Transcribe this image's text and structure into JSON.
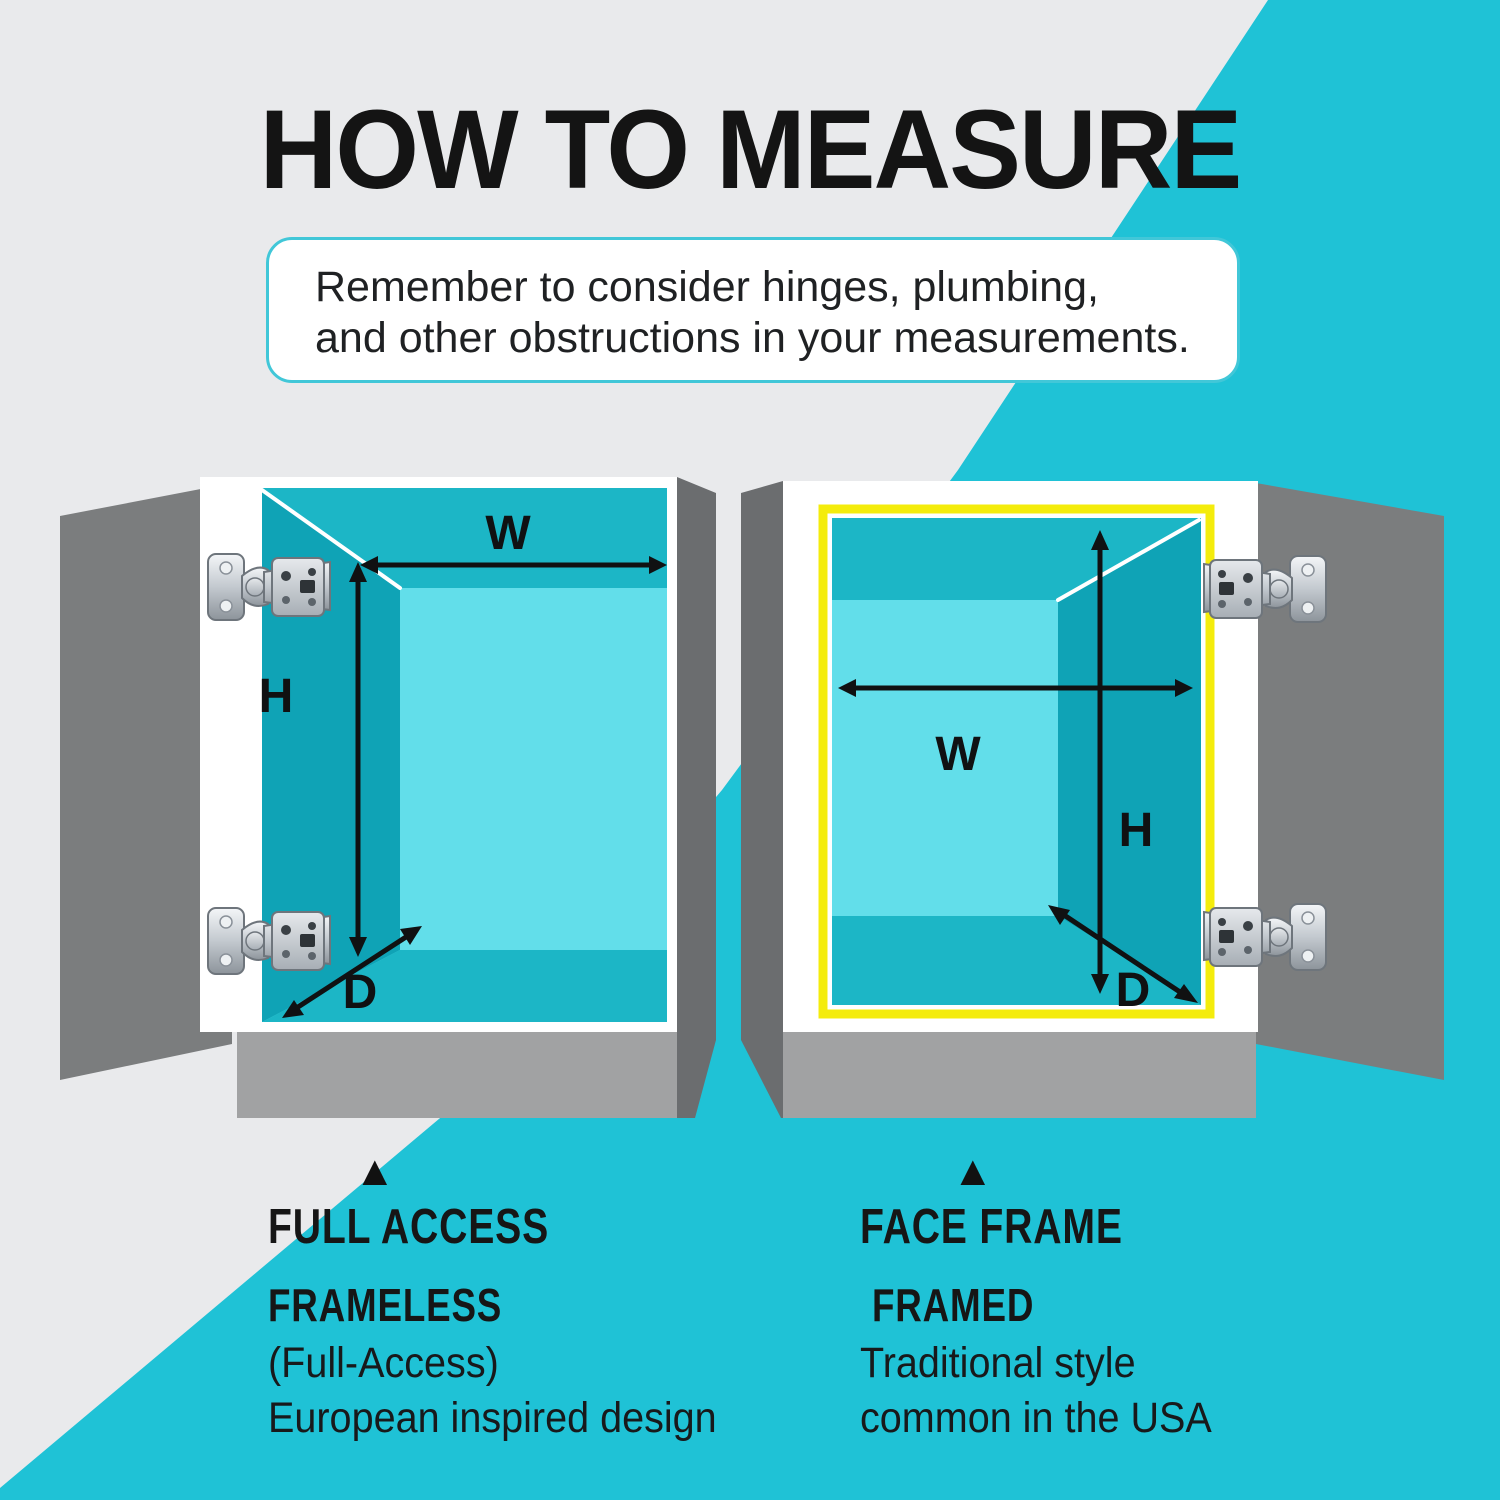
{
  "title": "HOW TO MEASURE",
  "note": {
    "line1": "Remember to consider hinges, plumbing,",
    "line2": "and other obstructions in your measurements."
  },
  "dimensions": {
    "width_label": "W",
    "height_label": "H",
    "depth_label": "D"
  },
  "left_caption": {
    "marker": "▲",
    "heading": "FULL ACCESS",
    "style_name": "FRAMELESS",
    "detail_line1": "(Full-Access)",
    "detail_line2": "European inspired design"
  },
  "right_caption": {
    "marker": "▲",
    "heading": "FACE FRAME",
    "style_name": "FRAMED",
    "detail_line1": "Traditional style",
    "detail_line2": "common in the USA"
  },
  "colors": {
    "background_gray": "#e9eaec",
    "accent_teal": "#1fc2d6",
    "note_border_teal": "#41c7d8",
    "frame_yellow": "#f4ec0c",
    "door_gray": "#7b7d7e",
    "side_panel_gray": "#6b6d6f",
    "base_gray": "#a1a2a3",
    "cabinet_white": "#ffffff",
    "interior_wall_teal": "#1cb6c6",
    "interior_dark_wall_teal": "#0fa3b6",
    "interior_back_cyan": "#62deea",
    "arrow_black": "#111111"
  }
}
